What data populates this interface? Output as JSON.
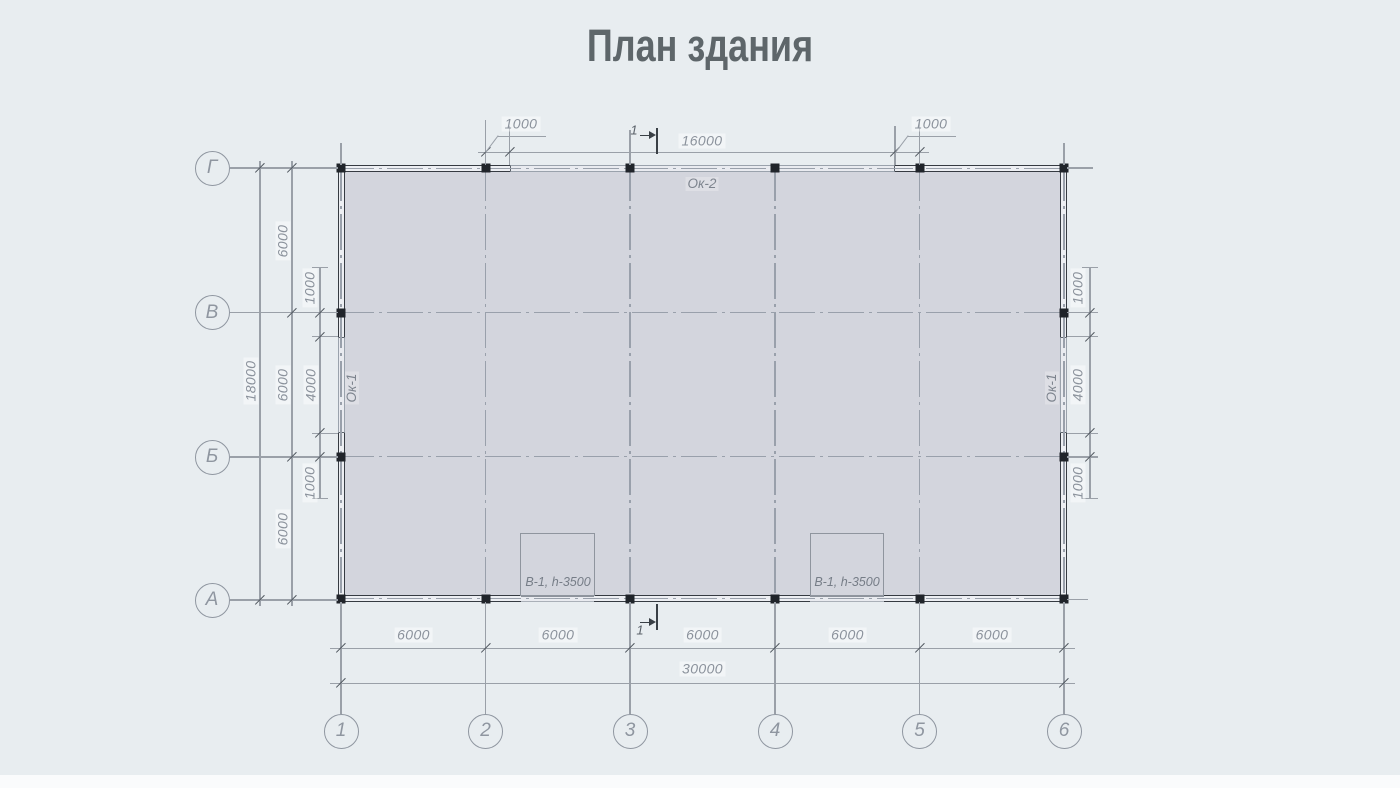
{
  "title": "План здания",
  "axes": {
    "cols": [
      "1",
      "2",
      "3",
      "4",
      "5",
      "6"
    ],
    "rows": [
      "Г",
      "В",
      "Б",
      "А"
    ]
  },
  "dims": {
    "top": {
      "offset_left": "1000",
      "window": "16000",
      "offset_right": "1000"
    },
    "bottom": {
      "spans": [
        "6000",
        "6000",
        "6000",
        "6000",
        "6000"
      ],
      "total": "30000"
    },
    "left": {
      "total": "18000",
      "spans": [
        "6000",
        "6000",
        "6000"
      ],
      "window_offsets": [
        "1000",
        "4000",
        "1000"
      ]
    },
    "right": {
      "window_offsets": [
        "1000",
        "4000",
        "1000"
      ]
    }
  },
  "labels": {
    "window_top": "Ок-2",
    "window_side_left": "Ок-1",
    "window_side_right": "Ок-1",
    "door_left": "В-1, h-3500",
    "door_right": "В-1, h-3500",
    "section_cut_top": "1",
    "section_cut_bottom": "1"
  },
  "colors": {
    "background": "#e8edf0",
    "floor_fill": "#d3d5dd",
    "wall_line": "#363b42",
    "grid_line": "#99a0ab",
    "dim_line": "#9aa0a8",
    "dim_text": "#8b929c",
    "title_text": "#5e666a"
  }
}
